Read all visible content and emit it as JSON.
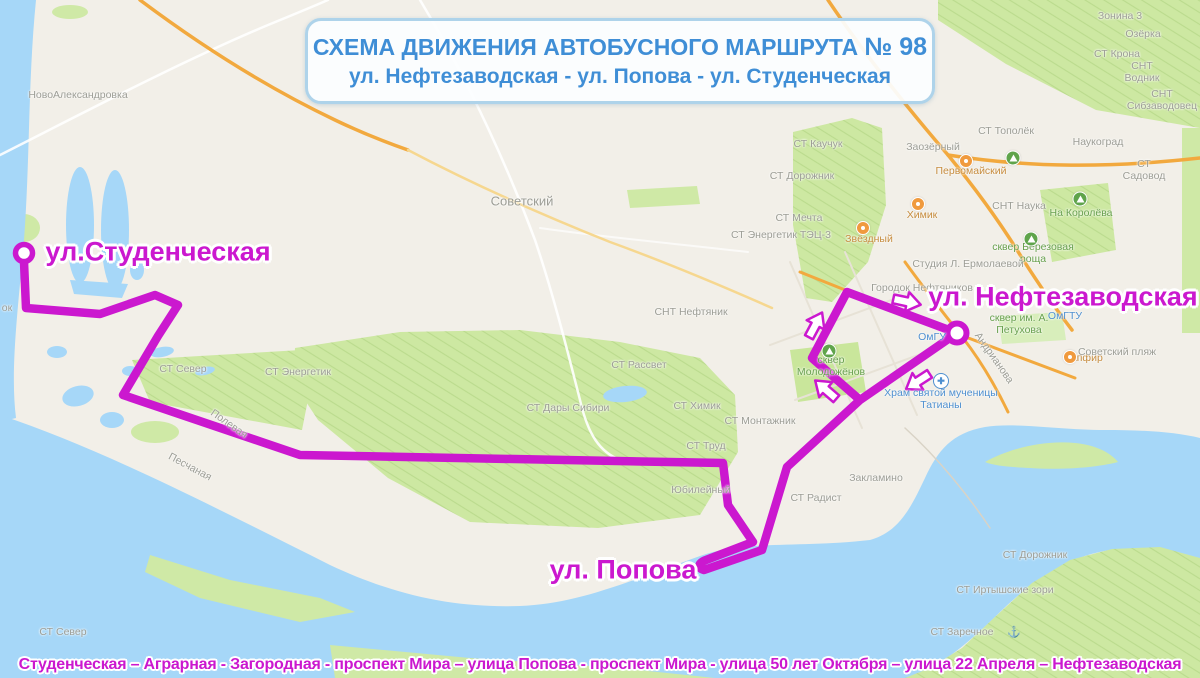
{
  "title": {
    "prefix": "СХЕМА ДВИЖЕНИЯ АВТОБУСНОГО МАРШРУТА ",
    "number": "№ 98",
    "line2": "ул. Нефтезаводская - ул. Попова - ул. Студенческая"
  },
  "route": {
    "number": "98",
    "color": "#cb18cf",
    "streets_line": "Студенческая – Аграрная - Загородная - проспект Мира – улица Попова - проспект Мира - улица 50 лет Октября – улица 22 Апреля – Нефтезаводская",
    "stop_labels": [
      {
        "text": "ул.Студенческая",
        "x": 158,
        "y": 252
      },
      {
        "text": "ул. Нефтезаводская",
        "x": 1063,
        "y": 297
      },
      {
        "text": "ул. Попова",
        "x": 623,
        "y": 570
      }
    ]
  },
  "colors": {
    "route_magenta": "#cb18cf",
    "title_blue": "#3f8ed6",
    "water": "#a6d7f8",
    "land": "#f2efe8",
    "garden_green": "#cde8a2",
    "road_orange": "#f2a93e"
  },
  "map": {
    "labels": [
      {
        "t": "НовоАлександровка",
        "x": 78,
        "y": 95
      },
      {
        "t": "Советский",
        "x": 522,
        "y": 202,
        "s": 13
      },
      {
        "t": "СТ Каучук",
        "x": 818,
        "y": 144
      },
      {
        "t": "СТ Дорожник",
        "x": 802,
        "y": 176
      },
      {
        "t": "СТ Мечта",
        "x": 799,
        "y": 218
      },
      {
        "t": "СТ Энергетик ТЭЦ-3",
        "x": 781,
        "y": 235
      },
      {
        "t": "Звёздный",
        "x": 869,
        "y": 239,
        "c": "o"
      },
      {
        "t": "Химик",
        "x": 922,
        "y": 215,
        "c": "o"
      },
      {
        "t": "Первомайский",
        "x": 971,
        "y": 171,
        "c": "o"
      },
      {
        "t": "Заозёрный",
        "x": 933,
        "y": 147
      },
      {
        "t": "СТ Тополёк",
        "x": 1006,
        "y": 131
      },
      {
        "t": "Наукоград",
        "x": 1098,
        "y": 142
      },
      {
        "t": "СТ Садовод",
        "x": 1144,
        "y": 170
      },
      {
        "t": "СНТ Наука",
        "x": 1019,
        "y": 206
      },
      {
        "t": "На Королёва",
        "x": 1081,
        "y": 213,
        "c": "gr"
      },
      {
        "t": "сквер Березовая\nроща",
        "x": 1033,
        "y": 253,
        "c": "gr"
      },
      {
        "t": "СТ Крона",
        "x": 1117,
        "y": 54
      },
      {
        "t": "СНТ Водник",
        "x": 1142,
        "y": 72
      },
      {
        "t": "СНТ Сибзаводовец",
        "x": 1162,
        "y": 100
      },
      {
        "t": "Зонина 3",
        "x": 1120,
        "y": 16
      },
      {
        "t": "Озёрка",
        "x": 1143,
        "y": 34
      },
      {
        "t": "Студия Л. Ермолаевой",
        "x": 968,
        "y": 264
      },
      {
        "t": "Городок Нефтяников",
        "x": 922,
        "y": 288
      },
      {
        "t": "ОмГУ",
        "x": 932,
        "y": 337,
        "c": "b"
      },
      {
        "t": "ОмГТУ",
        "x": 1065,
        "y": 316,
        "c": "b"
      },
      {
        "t": "сквер им. А.\nПетухова",
        "x": 1019,
        "y": 324,
        "c": "gr"
      },
      {
        "t": "сквер\nМолодожёнов",
        "x": 831,
        "y": 366,
        "c": "gr"
      },
      {
        "t": "Храм святой мученицы\nТатианы",
        "x": 941,
        "y": 399,
        "c": "b"
      },
      {
        "t": "Сапфир",
        "x": 1083,
        "y": 358,
        "c": "o"
      },
      {
        "t": "Советский пляж",
        "x": 1117,
        "y": 352
      },
      {
        "t": "Андрианова",
        "x": 994,
        "y": 358,
        "r": 55
      },
      {
        "t": "СНТ Нефтяник",
        "x": 691,
        "y": 312
      },
      {
        "t": "СТ Рассвет",
        "x": 639,
        "y": 365
      },
      {
        "t": "СТ Дары Сибири",
        "x": 568,
        "y": 408
      },
      {
        "t": "СТ Химик",
        "x": 697,
        "y": 406
      },
      {
        "t": "СТ Монтажник",
        "x": 760,
        "y": 421
      },
      {
        "t": "СТ Труд",
        "x": 706,
        "y": 446
      },
      {
        "t": "Юбилейный",
        "x": 701,
        "y": 490
      },
      {
        "t": "СТ Радист",
        "x": 816,
        "y": 498
      },
      {
        "t": "Закламино",
        "x": 876,
        "y": 478
      },
      {
        "t": "СТ Север",
        "x": 183,
        "y": 369
      },
      {
        "t": "СТ Энергетик",
        "x": 298,
        "y": 372
      },
      {
        "t": "Полевая",
        "x": 229,
        "y": 424,
        "r": 35
      },
      {
        "t": "Песчаная",
        "x": 190,
        "y": 467,
        "r": 28
      },
      {
        "t": "СТ Дорожник",
        "x": 1035,
        "y": 555
      },
      {
        "t": "СТ Иртышские зори",
        "x": 1005,
        "y": 590
      },
      {
        "t": "СТ Заречное",
        "x": 962,
        "y": 632
      },
      {
        "t": "СТ Север",
        "x": 63,
        "y": 632
      },
      {
        "t": "ок",
        "x": 7,
        "y": 308
      }
    ],
    "icons": [
      {
        "type": "tree",
        "x": 1013,
        "y": 158
      },
      {
        "type": "tree",
        "x": 1080,
        "y": 199
      },
      {
        "type": "tree",
        "x": 1031,
        "y": 239
      },
      {
        "type": "tree",
        "x": 829,
        "y": 351
      },
      {
        "type": "poi",
        "x": 966,
        "y": 161
      },
      {
        "type": "poi",
        "x": 918,
        "y": 204
      },
      {
        "type": "poi",
        "x": 863,
        "y": 228
      },
      {
        "type": "poi",
        "x": 1070,
        "y": 357
      },
      {
        "type": "church",
        "x": 941,
        "y": 381,
        "glyph": "✚"
      },
      {
        "type": "anchor",
        "x": 1014,
        "y": 632,
        "glyph": "⚓"
      }
    ],
    "arrows": [
      {
        "x": 908,
        "y": 302,
        "rot": 12
      },
      {
        "x": 816,
        "y": 324,
        "rot": -62
      },
      {
        "x": 825,
        "y": 389,
        "rot": -139
      },
      {
        "x": 917,
        "y": 382,
        "rot": 147
      }
    ]
  }
}
